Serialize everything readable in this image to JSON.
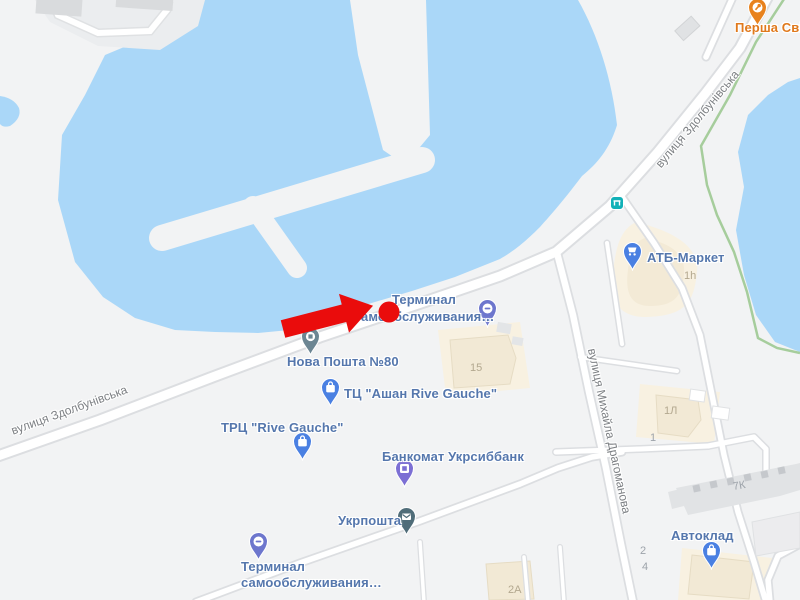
{
  "map": {
    "streets": {
      "zdolbunivska": "вулиця Здолбунівська",
      "drahomanova": "вулиця Михайла Драгоманова"
    },
    "pois": {
      "persha": {
        "label": "Перша Сві",
        "category": "food"
      },
      "atb": {
        "label": "АТБ-Маркет",
        "category": "supermarket"
      },
      "terminal_top": {
        "line1": "Терминал",
        "line2": "самообслуживания…",
        "category": "self-service terminal"
      },
      "nova_poshta": {
        "label": "Нова Пошта №80",
        "category": "post"
      },
      "ashan": {
        "label": "ТЦ \"Ашан Rive Gauche\"",
        "category": "mall"
      },
      "rive_gauche": {
        "label": "ТРЦ \"Rive Gauche\"",
        "category": "mall"
      },
      "bankomat": {
        "label": "Банкомат Укрсиббанк",
        "category": "atm"
      },
      "ukrposhta": {
        "label": "Укрпошта",
        "category": "post"
      },
      "terminal_bottom": {
        "line1": "Терминал",
        "line2": "самообслуживания…",
        "category": "self-service terminal"
      },
      "avtoklad": {
        "label": "Автоклад",
        "category": "store"
      }
    },
    "buildings": {
      "b1h": "1h",
      "b15": "15",
      "b1l": "1Л",
      "b1": "1",
      "b7k": "7К",
      "b2": "2",
      "b4": "4",
      "b2a": "2А"
    },
    "colors": {
      "water": "#aad7f8",
      "land": "#f2f3f4",
      "road_fill": "#ffffff",
      "road_casing": "#dcdee1",
      "commercial_area": "#f8f1e1",
      "building_beige": "#f2e9d5",
      "building_gray": "#e1e3e5",
      "green_path": "#a6cd9c",
      "poi_label": "#5577ad",
      "food_label": "#e0791c",
      "street_label": "#7d8084",
      "marker_red": "#ea0c0c",
      "pin_blue": "#4a80e2",
      "pin_indigo": "#6d76cd",
      "pin_purple": "#7c6fd4",
      "pin_gray": "#6c8693",
      "pin_dark_teal": "#506d79",
      "pin_orange": "#e8821e",
      "transit_teal": "#12b1b8"
    },
    "annotation": {
      "description": "red arrow pointing at red dot location marker"
    }
  }
}
